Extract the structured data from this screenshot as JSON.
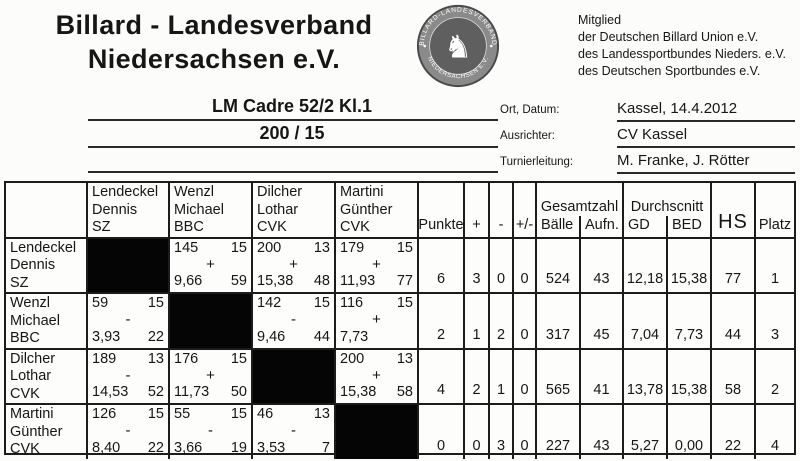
{
  "header": {
    "title_line1": "Billard - Landesverband",
    "title_line2": "Niedersachsen e.V.",
    "seal": {
      "text_top": "BILLARD-LANDESVERBAND",
      "text_bottom": "NIEDERSACHSEN E.V.",
      "symbol": "rearing-horse",
      "ring_color": "#8a8a8a",
      "center_color": "#5f5f5f"
    },
    "membership": [
      "Mitglied",
      "der Deutschen Billard Union e.V.",
      "des Landessportbundes Nieders. e.V.",
      "des Deutschen Sportbundes e.V."
    ]
  },
  "event": {
    "title": "LM Cadre 52/2 Kl.1",
    "distance": "200 / 15",
    "meta": [
      {
        "label": "Ort, Datum:",
        "value": "Kassel, 14.4.2012"
      },
      {
        "label": "Ausrichter:",
        "value": "CV Kassel"
      },
      {
        "label": "Turnierleitung:",
        "value": "M. Franke, J. Rötter"
      }
    ]
  },
  "table": {
    "opponents": [
      {
        "name": "Lendeckel",
        "first": "Dennis",
        "club": "SZ"
      },
      {
        "name": "Wenzl",
        "first": "Michael",
        "club": "BBC"
      },
      {
        "name": "Dilcher",
        "first": "Lothar",
        "club": "CVK"
      },
      {
        "name": "Martini",
        "first": "Günther",
        "club": "CVK"
      }
    ],
    "stat_headers": {
      "punkte": "Punkte",
      "plus": "+",
      "minus": "-",
      "plusminus": "+/-",
      "gesamtzahl": "Gesamtzahl",
      "baelle": "Bälle",
      "aufn": "Aufn.",
      "durchschnitt": "Durchscnitt",
      "gd": "GD",
      "bed": "BED",
      "hs": "HS",
      "platz": "Platz"
    },
    "rows": [
      {
        "player": {
          "name": "Lendeckel",
          "first": "Dennis",
          "club": "SZ"
        },
        "matches": [
          {
            "self": true
          },
          {
            "score": "145",
            "innings": "15",
            "sign": "+",
            "avg": "9,66",
            "high": "59"
          },
          {
            "score": "200",
            "innings": "13",
            "sign": "+",
            "avg": "15,38",
            "high": "48"
          },
          {
            "score": "179",
            "innings": "15",
            "sign": "+",
            "avg": "11,93",
            "high": "77"
          }
        ],
        "stats": {
          "punkte": "6",
          "plus": "3",
          "minus": "0",
          "plusminus": "0",
          "baelle": "524",
          "aufn": "43",
          "gd": "12,18",
          "bed": "15,38",
          "hs": "77",
          "platz": "1"
        }
      },
      {
        "player": {
          "name": "Wenzl",
          "first": "Michael",
          "club": "BBC"
        },
        "matches": [
          {
            "score": "59",
            "innings": "15",
            "sign": "-",
            "avg": "3,93",
            "high": "22"
          },
          {
            "self": true
          },
          {
            "score": "142",
            "innings": "15",
            "sign": "-",
            "avg": "9,46",
            "high": "44"
          },
          {
            "score": "116",
            "innings": "15",
            "sign": "+",
            "avg": "7,73",
            "high": ""
          }
        ],
        "stats": {
          "punkte": "2",
          "plus": "1",
          "minus": "2",
          "plusminus": "0",
          "baelle": "317",
          "aufn": "45",
          "gd": "7,04",
          "bed": "7,73",
          "hs": "44",
          "platz": "3"
        }
      },
      {
        "player": {
          "name": "Dilcher",
          "first": "Lothar",
          "club": "CVK"
        },
        "matches": [
          {
            "score": "189",
            "innings": "13",
            "sign": "-",
            "avg": "14,53",
            "high": "52"
          },
          {
            "score": "176",
            "innings": "15",
            "sign": "+",
            "avg": "11,73",
            "high": "50"
          },
          {
            "self": true
          },
          {
            "score": "200",
            "innings": "13",
            "sign": "+",
            "avg": "15,38",
            "high": "58"
          }
        ],
        "stats": {
          "punkte": "4",
          "plus": "2",
          "minus": "1",
          "plusminus": "0",
          "baelle": "565",
          "aufn": "41",
          "gd": "13,78",
          "bed": "15,38",
          "hs": "58",
          "platz": "2"
        }
      },
      {
        "player": {
          "name": "Martini",
          "first": "Günther",
          "club": "CVK"
        },
        "matches": [
          {
            "score": "126",
            "innings": "15",
            "sign": "-",
            "avg": "8,40",
            "high": "22"
          },
          {
            "score": "55",
            "innings": "15",
            "sign": "-",
            "avg": "3,66",
            "high": "19"
          },
          {
            "score": "46",
            "innings": "13",
            "sign": "-",
            "avg": "3,53",
            "high": "7"
          },
          {
            "self": true
          }
        ],
        "stats": {
          "punkte": "0",
          "plus": "0",
          "minus": "3",
          "plusminus": "0",
          "baelle": "227",
          "aufn": "43",
          "gd": "5,27",
          "bed": "0,00",
          "hs": "22",
          "platz": "4"
        }
      }
    ]
  }
}
